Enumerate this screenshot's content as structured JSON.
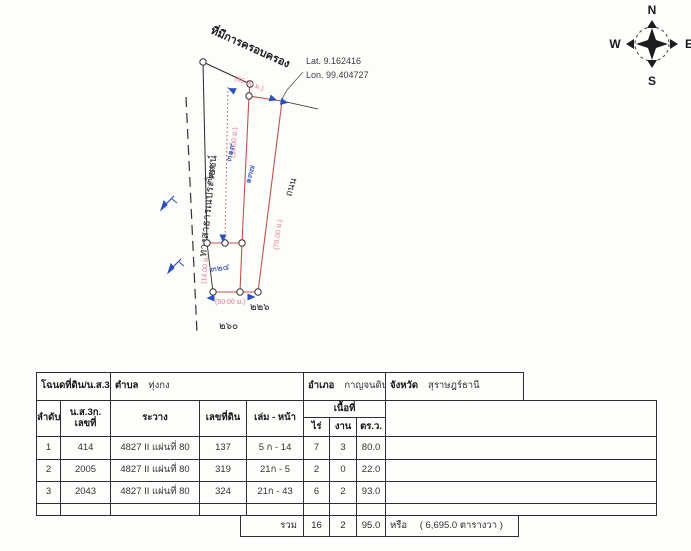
{
  "diagram": {
    "possession_title": "ที่มีการครอบครอง",
    "lat": "Lat. 9.162416",
    "lon": "Lon. 99.404727",
    "public_road_label": "ทางสาธารณประโยชน์",
    "road_label": "ถนน",
    "parcels": {
      "p319": "๓๑๙",
      "p137": "๑๓๗",
      "p324": "๓๒๔"
    },
    "neighbors": {
      "n318": "๓๑๘",
      "n260": "๒๖๐",
      "n226": "๒๒๖"
    },
    "dims": {
      "top": "(66.00 ม.)",
      "west_strip": "(34.00 ม.)",
      "east_strip": "(70.00 ม.)",
      "quad_west": "(14.00 ม.)",
      "quad_south": "(50.00 ม.)"
    },
    "compass": {
      "n": "N",
      "e": "E",
      "s": "S",
      "w": "W"
    },
    "colors": {
      "boundary_red": "#c4524a",
      "dim_pink": "#e27694",
      "marker_blue": "#2b4fc0",
      "ink": "#2b2b2b"
    }
  },
  "table": {
    "header": {
      "deed_label": "โฉนดที่ดิน/น.ส.3ก",
      "tambon_label": "ตำบล",
      "tambon_value": "ทุ่งกง",
      "amphoe_label": "อำเภอ",
      "amphoe_value": "กาญจนดิษฐ์",
      "province_label": "จังหวัด",
      "province_value": "สุราษฎร์ธานี",
      "col_order": "ลำดับ",
      "col_ns3k_line1": "น.ส.3ก.",
      "col_ns3k_line2": "เลขที่",
      "col_rawang": "ระวาง",
      "col_land_no": "เลขที่ดิน",
      "col_volume_page": "เล่ม - หน้า",
      "col_area": "เนื้อที่",
      "col_rai": "ไร่",
      "col_ngan": "งาน",
      "col_sqwah": "ตร.ว."
    },
    "rows": [
      {
        "order": "1",
        "ns3k": "414",
        "rawang": "4827 II แผ่นที่ 80",
        "land_no": "137",
        "volume_page": "5 ก - 14",
        "rai": "7",
        "ngan": "3",
        "sqwah": "80.0"
      },
      {
        "order": "2",
        "ns3k": "2005",
        "rawang": "4827 II แผ่นที่ 80",
        "land_no": "319",
        "volume_page": "21ก - 5",
        "rai": "2",
        "ngan": "0",
        "sqwah": "22.0"
      },
      {
        "order": "3",
        "ns3k": "2043",
        "rawang": "4827 II แผ่นที่ 80",
        "land_no": "324",
        "volume_page": "21ก - 43",
        "rai": "6",
        "ngan": "2",
        "sqwah": "93.0"
      }
    ],
    "total": {
      "label": "รวม",
      "rai": "16",
      "ngan": "2",
      "sqwah": "95.0",
      "alt": "หรือ",
      "alt_value": "(  6,695.0  ตารางวา )"
    }
  }
}
